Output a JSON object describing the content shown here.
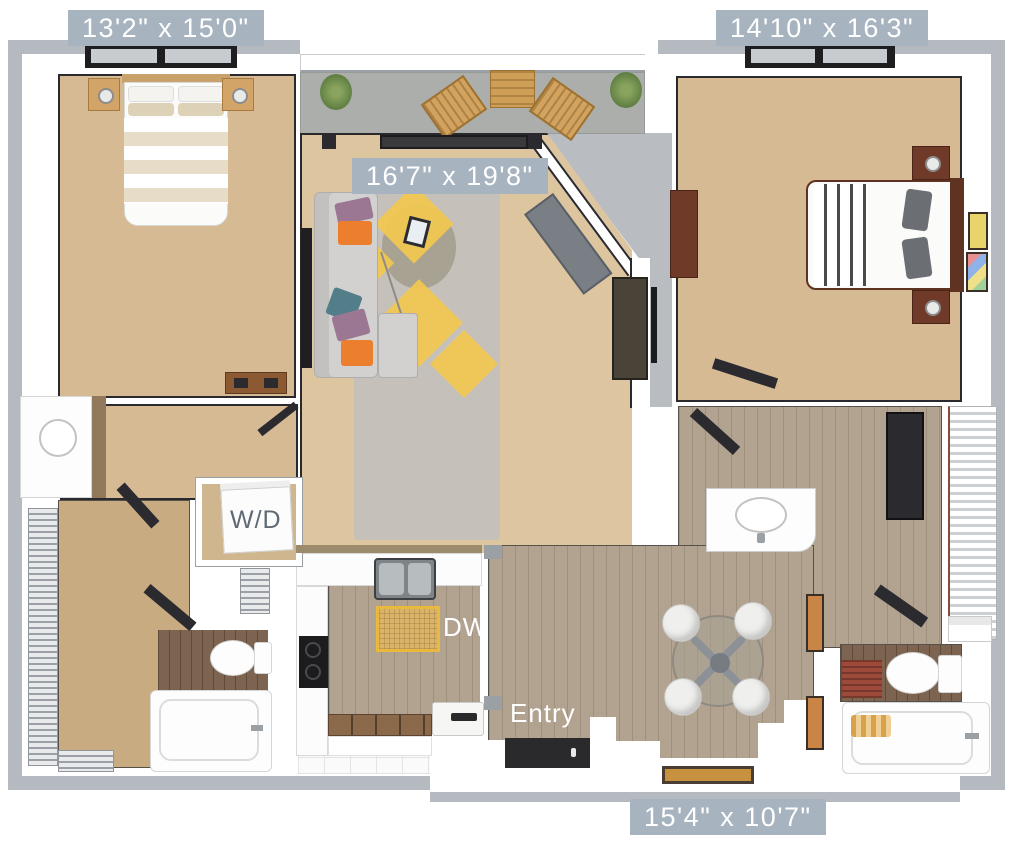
{
  "plan": {
    "kind": "apartment-floor-plan",
    "view": "3d-top-down-render",
    "rooms": [
      "bedroom-1",
      "balcony",
      "living-room",
      "bedroom-2",
      "hallway-closet",
      "bathroom-1",
      "bathroom-2",
      "kitchen",
      "dining-entry"
    ]
  },
  "labels": {
    "bedroom1_dim": "13'2\" x 15'0\"",
    "bedroom2_dim": "14'10\" x 16'3\"",
    "living_dim": "16'7\" x 19'8\"",
    "dining_dim": "15'4\" x 10'7\"",
    "washer_dryer": "W/D",
    "dishwasher": "DW",
    "entry": "Entry"
  },
  "colors": {
    "dimension_label_bg": "#a7b4c0",
    "dimension_label_text": "#ffffff",
    "wd_label_text": "#5f6a74",
    "carpet": "#d6ba93",
    "living_floor": "#ddc5a0",
    "plank_floor": "#b2a391",
    "dark_plank_floor": "#7c6450",
    "balcony_floor": "#abaeaa",
    "exterior_gray": "#b9bdc1",
    "outer_wall": "#b4bac0",
    "accent_yellow": "#f2c84f",
    "pillow_orange": "#ec7f2e",
    "pillow_purple": "#9b7793",
    "pillow_teal": "#517e88",
    "bath_mat_red": "#9e4a3a",
    "doormat_tan": "#c79140"
  }
}
